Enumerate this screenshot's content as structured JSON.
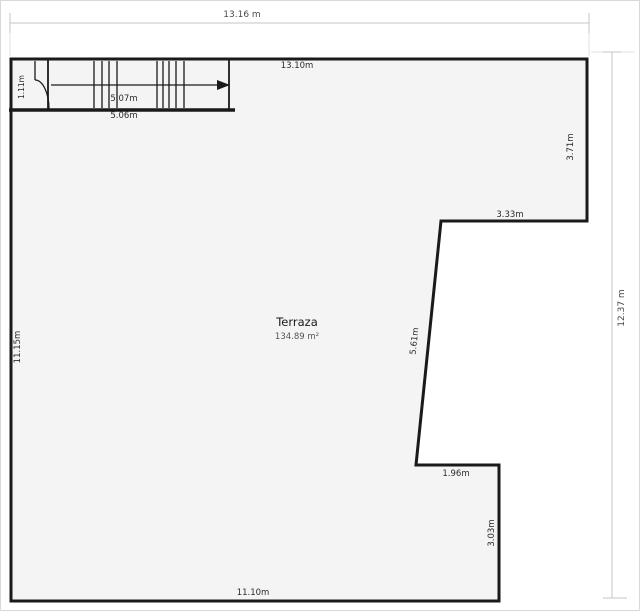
{
  "plan": {
    "room": {
      "name": "Terraza",
      "area": "134.89 m²"
    },
    "dimensions": {
      "outer_width": "13.16 m",
      "outer_height": "12.37 m",
      "top_inner": "13.10m",
      "left_wall": "11.15m",
      "bottom_wall": "11.10m",
      "right_upper_wall": "3.71m",
      "notch_top_wall": "3.33m",
      "slant_wall": "5.61m",
      "step_bottom_wall": "1.96m",
      "step_right_wall": "3.03m",
      "stair_inner": "5.07m",
      "stair_outer": "5.06m",
      "door_alcove": "1.11m"
    },
    "colors": {
      "wall": "#1a1a1a",
      "floor_fill": "#f4f4f4",
      "dimension_line": "#c4c4c4",
      "dimension_text": "#4a4a4a",
      "label_text": "#2a2a2a",
      "area_text": "#555555",
      "frame_border": "#d9d9d9",
      "background": "#ffffff"
    }
  }
}
